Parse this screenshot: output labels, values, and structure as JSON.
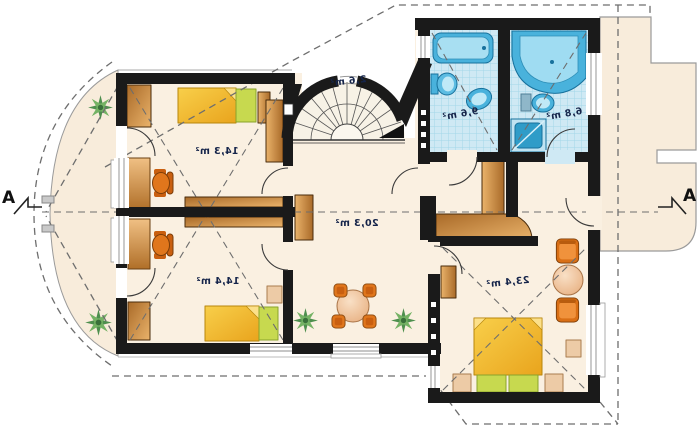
{
  "plan": {
    "section_marker": "A",
    "rooms": [
      {
        "key": "bedroom-top-left",
        "area": "14,3 m²"
      },
      {
        "key": "bedroom-bottom-left",
        "area": "14,4 m²"
      },
      {
        "key": "hall",
        "area": "20,3 m²"
      },
      {
        "key": "staircase",
        "area": "2,6 m²"
      },
      {
        "key": "bathroom-left",
        "area": "9,6 m²"
      },
      {
        "key": "bathroom-right",
        "area": "6,8 m²"
      },
      {
        "key": "bedroom-right",
        "area": "23,4 m²"
      }
    ],
    "furniture_icons": [
      "bed",
      "desk",
      "office-chair",
      "wardrobe",
      "dining-table",
      "dining-chair",
      "armchair",
      "coffee-table",
      "bathtub",
      "corner-bathtub",
      "toilet",
      "washbasin",
      "shower",
      "spiral-staircase",
      "plant",
      "radiator"
    ],
    "colors": {
      "wall": "#1a1a1a",
      "floor": "#faf0e1",
      "balcony": "#f8ecdb",
      "tile": "#cfe9f4",
      "fixture_blue": "#49b2dc",
      "wood_dark": "#a96a28",
      "wood_light": "#eab36b",
      "bed_yellow": "#f2b32a",
      "pillow_green": "#c7d94f",
      "chair_orange": "#e0761c",
      "dashed_line": "#6e6e6e",
      "label_text": "#15244a"
    }
  }
}
